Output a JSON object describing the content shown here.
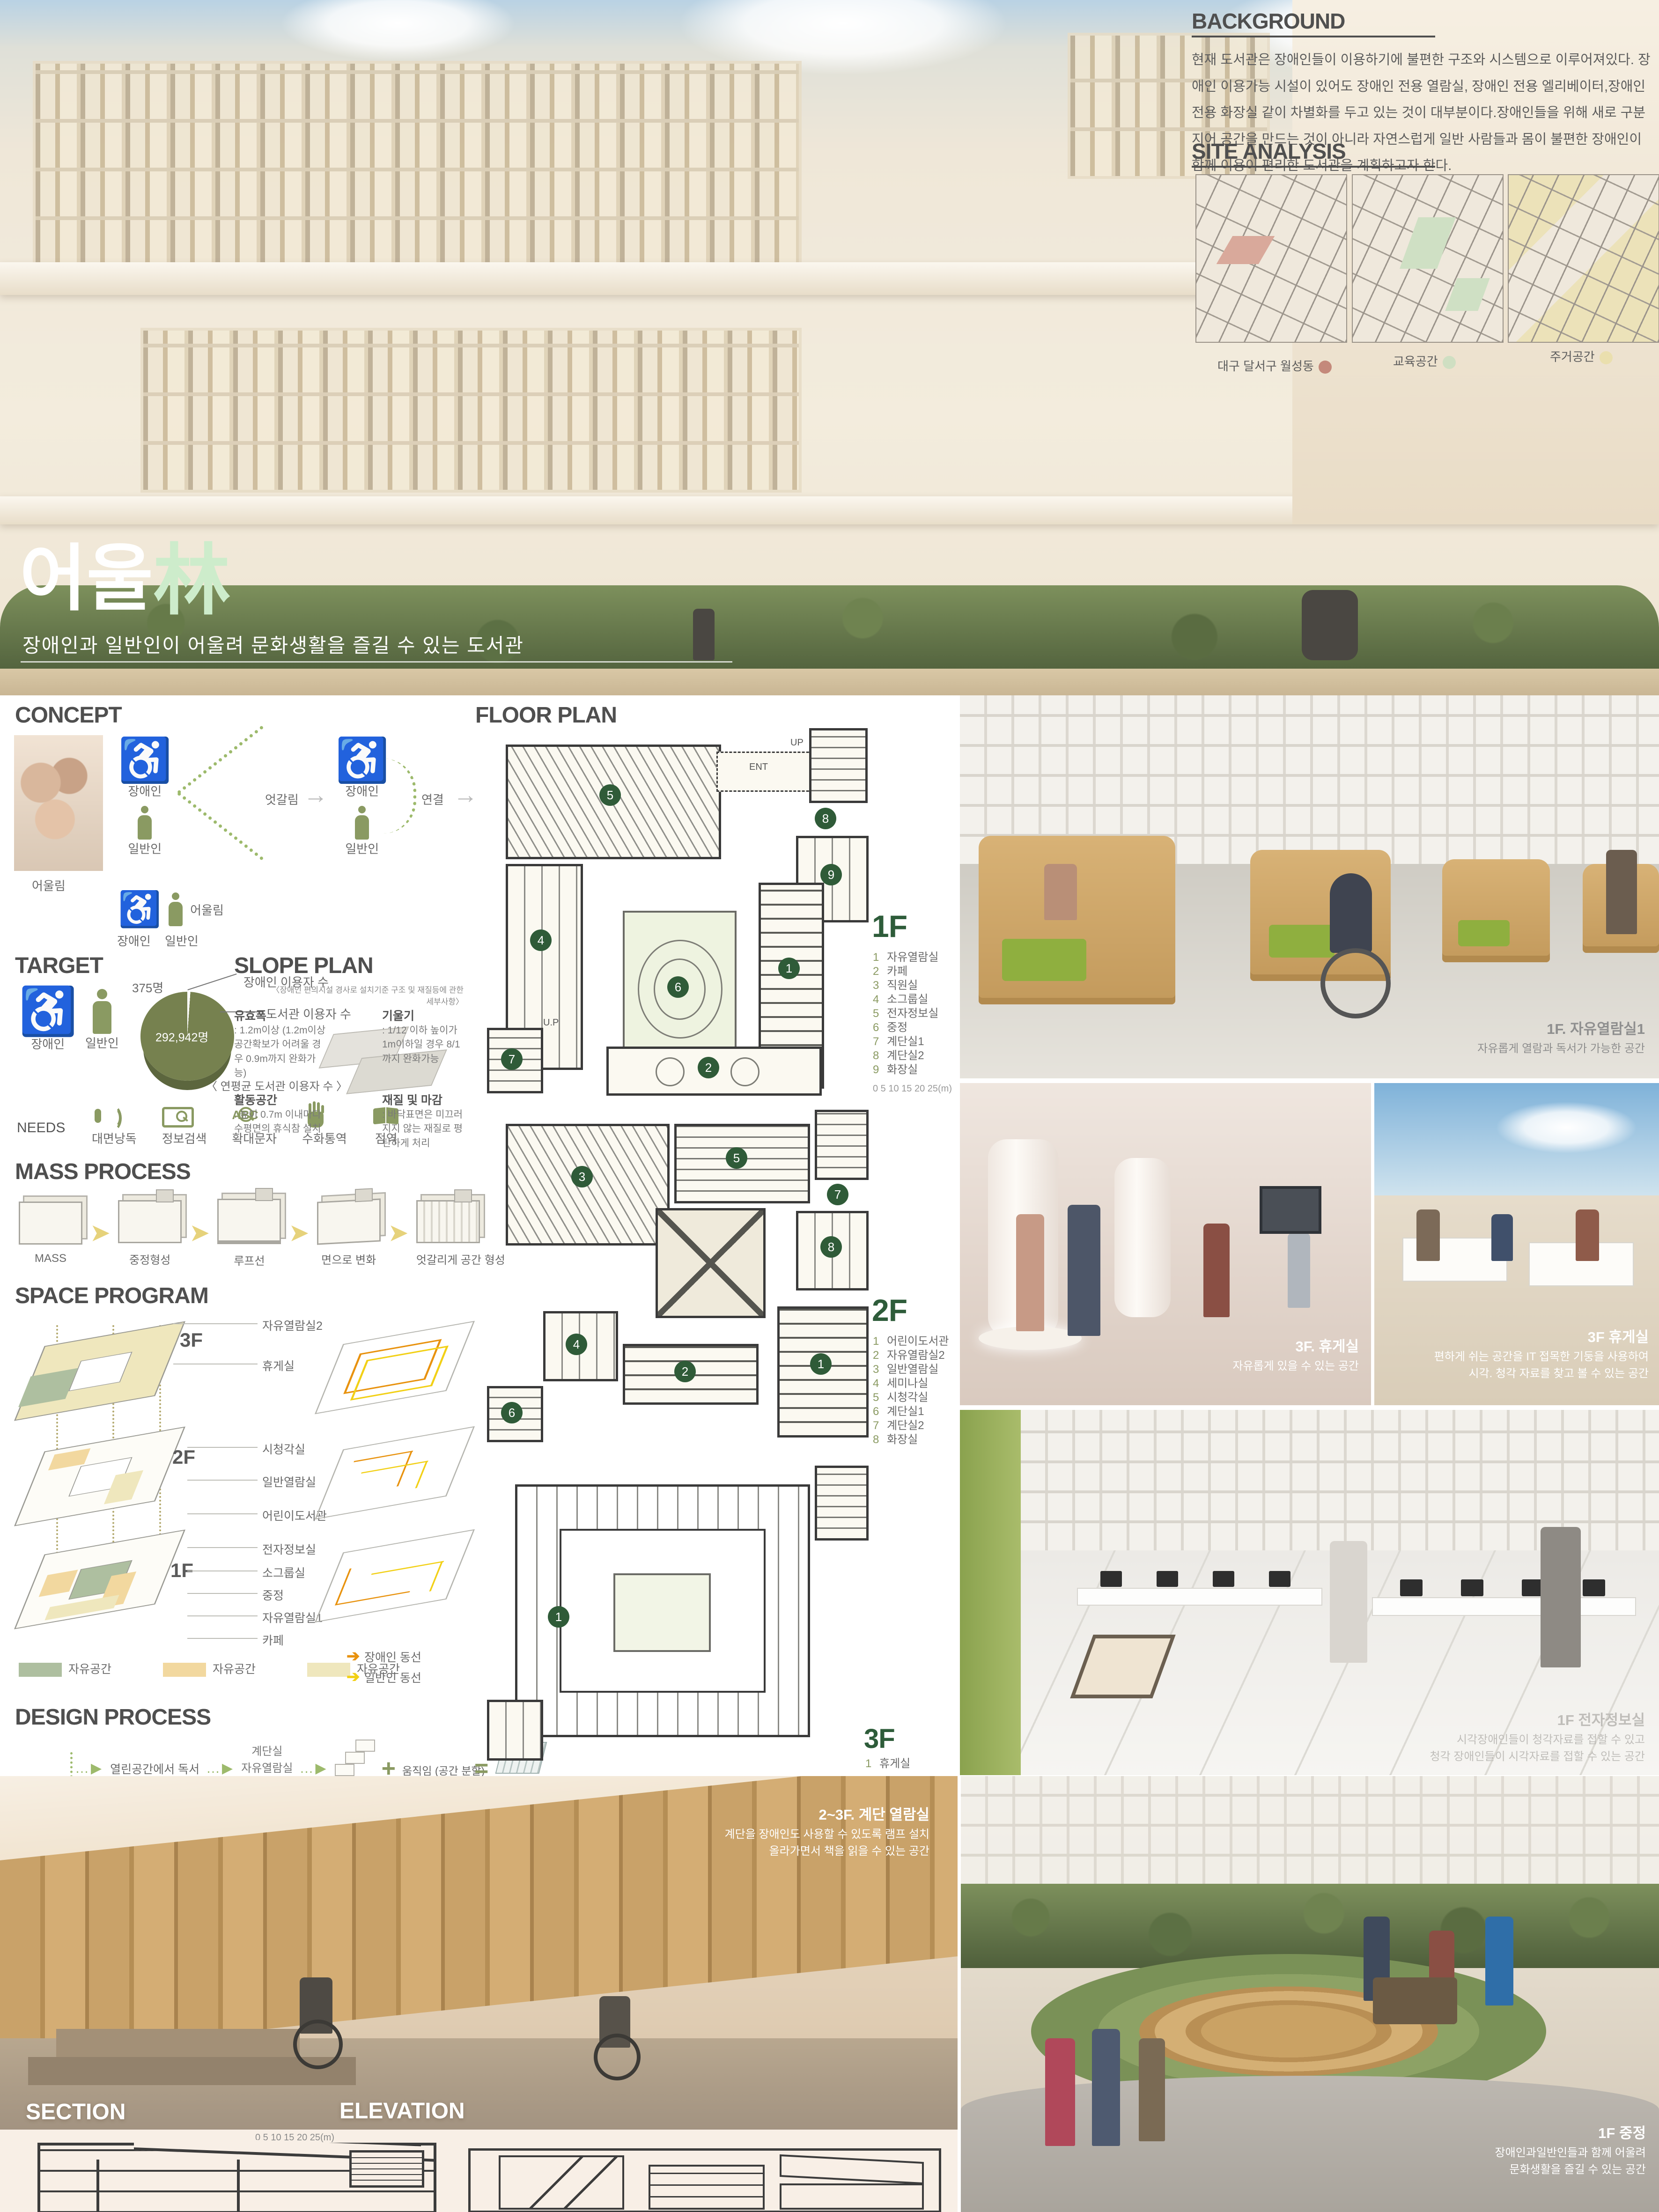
{
  "hero": {
    "title": {
      "korean": "어울",
      "hanja": "林",
      "subtitle": "장애인과 일반인이 어울려 문화생활을 즐길 수 있는 도서관"
    },
    "background": {
      "title": "BACKGROUND",
      "body": "현재 도서관은 장애인들이 이용하기에 불편한 구조와 시스템으로 이루어져있다. 장애인 이용가능 시설이 있어도 장애인 전용 열람실, 장애인 전용 엘리베이터,장애인 전용 화장실 같이 차별화를 두고 있는 것이 대부분이다.장애인들을 위해 새로 구분 지어 공간을 만드는 것이 아니라 자연스럽게 일반 사람들과 몸이 불편한 장애인이 함께 이용이 편리한 도서관을 계획하고자 한다."
    },
    "site_analysis": {
      "title": "SITE ANALYSIS",
      "maps": [
        {
          "label": "대구 달서구 월성동",
          "dot": "#c4897b"
        },
        {
          "label": "교육공간",
          "dot": "#cfdfc2"
        },
        {
          "label": "주거공간",
          "dot": "#eadfae"
        }
      ]
    }
  },
  "concept": {
    "title": "CONCEPT",
    "photo_caption": "어울림",
    "group1": {
      "top": "장애인",
      "bottom": "일반인"
    },
    "cross_label": "엇갈림",
    "group2": {
      "top": "장애인",
      "bottom": "일반인"
    },
    "connect_label": "연결",
    "result": {
      "left": "장애인",
      "right": "일반인",
      "label": "어울림"
    }
  },
  "target": {
    "title": "TARGET",
    "persons": {
      "left": "장애인",
      "right": "일반인"
    },
    "pie": {
      "small_value": "375명",
      "small_label": "장애인 이용자 수",
      "big_value": "292,942명",
      "big_label": "도서관 이용자 수",
      "caption": "〈 연평균 도서관  이용자 수 〉"
    },
    "needs": {
      "label": "NEEDS",
      "items": [
        "대면낭독",
        "정보검색",
        "확대문자",
        "수화통역",
        "점역"
      ],
      "icons": [
        "voice-icon",
        "info-search-icon",
        "large-text-icon",
        "sign-language-icon",
        "braille-icon"
      ]
    }
  },
  "slope_plan": {
    "title": "SLOPE PLAN",
    "subtitle": "〈장애인  편의시설 경사로 설치기준 구조 및 재질등에 관한 세부사항〉",
    "items": [
      {
        "name": "유효폭",
        "desc": ": 1.2m이상 (1.2m이상 공간확보가 어려울 경우 0.9m까지 완화가능)"
      },
      {
        "name": "기울기",
        "desc": ": 1/12 이하 높이가 1m이하일 경우 8/1까지 완화가능"
      },
      {
        "name": "활동공간",
        "desc": ": 높이 0.7m 이내마다 수평면의 휴식참 설치"
      },
      {
        "name": "재질 및 마감",
        "desc": ": 바닥표면은 미끄러지지 않는 재질로 평탄하게 처리"
      }
    ]
  },
  "mass_process": {
    "title": "MASS PROCESS",
    "steps": [
      "MASS",
      "중정형성",
      "루프선",
      "면으로 변화",
      "엇갈리게 공간 형성"
    ]
  },
  "space_program": {
    "title": "SPACE PROGRAM",
    "floor3": {
      "marker": "3F",
      "rooms": [
        "자유열람실2",
        "휴게실"
      ]
    },
    "floor2": {
      "marker": "2F",
      "rooms": [
        "시청각실",
        "일반열람실",
        "어린이도서관"
      ]
    },
    "floor1": {
      "marker": "1F",
      "rooms": [
        "전자정보실",
        "소그룹실",
        "중정",
        "자유열람실1",
        "카페"
      ]
    },
    "legend": [
      {
        "label": "자유공간",
        "color": "#aebfa0"
      },
      {
        "label": "자유공간",
        "color": "#f2d89f"
      },
      {
        "label": "자유공간",
        "color": "#efe7bd"
      }
    ],
    "flows": [
      {
        "label": "장애인 동선",
        "color": "#e8920e"
      },
      {
        "label": "일반인 동선",
        "color": "#f2d016"
      }
    ]
  },
  "design_process": {
    "title": "DESIGN PROCESS",
    "root": "어울림",
    "rows": [
      {
        "goal": "열린공간에서 독서",
        "spaces": [
          "계단실",
          "자유열람실",
          "카페"
        ],
        "a": "일반계단",
        "b": "움직임 (공간 분할)",
        "r": "엇갈리는 층"
      },
      {
        "goal": "문화공간에서 즐기기",
        "spaces": [
          "카페",
          "전자정보실",
          "시청각실"
        ],
        "a": "책",
        "b": "카페",
        "r": "북카페"
      },
      {
        "goal": "자연친화적 공간에서 휴식하기",
        "spaces": [
          "계단실",
          "중정",
          "휴게실"
        ],
        "a": "일반계단",
        "b": "식물",
        "r": "자연친화적계단",
        "a2": "MASS",
        "b2": "식물",
        "r2": "중정"
      },
      {
        "goal": "휴게공간에서 IT즐기기",
        "spaces": [
          "휴게실"
        ],
        "a": "기둥",
        "b": "컴퓨터",
        "r": "옥상휴게실"
      }
    ]
  },
  "floor_plan": {
    "title": "FLOOR PLAN",
    "plan_labels": {
      "ent": "ENT",
      "up": "UP",
      "up2": "U.P"
    },
    "scale_note": "0   5   10   15   20   25(m)",
    "floors": [
      {
        "name": "1F",
        "legend": [
          {
            "n": "1",
            "label": "자유열람실"
          },
          {
            "n": "2",
            "label": "카페"
          },
          {
            "n": "3",
            "label": "직원실"
          },
          {
            "n": "4",
            "label": "소그룹실"
          },
          {
            "n": "5",
            "label": "전자정보실"
          },
          {
            "n": "6",
            "label": "중정"
          },
          {
            "n": "7",
            "label": "계단실1"
          },
          {
            "n": "8",
            "label": "계단실2"
          },
          {
            "n": "9",
            "label": "화장실"
          }
        ]
      },
      {
        "name": "2F",
        "legend": [
          {
            "n": "1",
            "label": "어린이도서관"
          },
          {
            "n": "2",
            "label": "자유열람실2"
          },
          {
            "n": "3",
            "label": "일반열람실"
          },
          {
            "n": "4",
            "label": "세미나실"
          },
          {
            "n": "5",
            "label": "시청각실"
          },
          {
            "n": "6",
            "label": "계단실1"
          },
          {
            "n": "7",
            "label": "계단실2"
          },
          {
            "n": "8",
            "label": "화장실"
          }
        ]
      },
      {
        "name": "3F",
        "legend": [
          {
            "n": "1",
            "label": "휴게실"
          }
        ]
      }
    ]
  },
  "photos": [
    {
      "title": "1F. 자유열람실1",
      "lines": [
        "자유롭게 열람과 독서가 가능한 공간"
      ]
    },
    {
      "title": "3F. 휴게실",
      "lines": [
        "자유롭게 있을 수 있는 공간"
      ]
    },
    {
      "title": "3F 휴게실",
      "lines": [
        "편하게 쉬는 공간을 IT 접목한 기둥을 사용하여",
        "시각. 청각 자료를 찾고 볼 수 있는 공간"
      ]
    },
    {
      "title": "1F 전자정보실",
      "lines": [
        "시각장애인들이 청각자료를 접할 수 있고",
        "청각 장애인들이 시각자료를 접할 수 있는 공간"
      ]
    }
  ],
  "bottom": {
    "stair_caption": {
      "title": "2~3F. 계단 열람실",
      "lines": [
        "계단을 장애인도 사용할 수 있도록 램프 설치",
        "올라가면서 책을 읽을 수 있는 공간"
      ]
    },
    "section_label": "SECTION",
    "elevation_label": "ELEVATION",
    "scale_bar_text": "0     5     10     15     20     25(m)",
    "courtyard_caption": {
      "title": "1F 중정",
      "lines": [
        "장애인과일반인들과 함께 어울려",
        "문화생활을 즐길 수 있는 공간"
      ]
    }
  }
}
